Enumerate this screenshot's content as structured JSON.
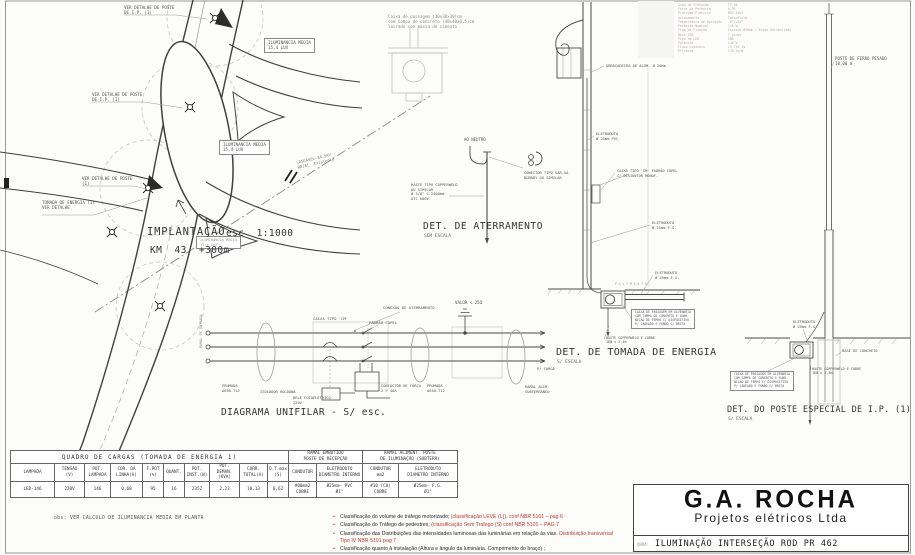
{
  "sheet": {
    "bg": "#fcfcfb",
    "line": "#3c3c3c",
    "grey": "#9a9a9a",
    "red": "#c0392b"
  },
  "plan": {
    "title": "IMPLANTAÇÃO",
    "scale": "esc  1:1000",
    "km": "KM  43  +300m"
  },
  "sections": {
    "aterramento": {
      "title": "DET. DE ATERRAMENTO",
      "subtitle": "SEM ESCALA"
    },
    "unifilar": {
      "title": "DIAGRAMA UNIFILAR - S/ esc."
    },
    "tomada": {
      "title": "DET. DE TOMADA DE ENERGIA",
      "subtitle": "S/ ESCALA"
    },
    "poste": {
      "title": "DET. DO POSTE ESPECIAL DE I.P. (1)",
      "subtitle": "S/ ESCALA"
    }
  },
  "luminaire": {
    "specs": [
      "Grau de Proteção          IP-66",
      "Fator de Potência         0,95",
      "Proteção Elétrica         MOV 10kV",
      "Acionamento               Fotocélula",
      "Temperatura de Operação   -5°/+45°",
      "Potência Nominal          146 W",
      "Tipo de Fixação           Encaixe Ø48mm / Braço Galvanizado",
      "Base LED                  7 pinos",
      "Tipo de LED               SMD",
      "Potência                  146 W",
      "Fluxo Luminoso            19.710 lm",
      "Eficácia                  135 lm/W"
    ]
  },
  "annotations": [
    {
      "n": "ver-detalhe-poste-1",
      "x": 124,
      "y": 5,
      "t": "VER DETALHE DE POSTE\nDE I.P. (1)"
    },
    {
      "n": "iluminancia-media-1",
      "x": 264,
      "y": 38,
      "t": "ILUMINANCIA MEDIA\n15,4 LUX",
      "box": true
    },
    {
      "n": "ver-detalhe-poste-2",
      "x": 92,
      "y": 92,
      "t": "VER DETALHE DE POSTE\nDE I.P. (1)"
    },
    {
      "n": "iluminancia-media-2",
      "x": 219,
      "y": 140,
      "t": "ILUMINANCIA MEDIA\n15,4 LUX",
      "box": true
    },
    {
      "n": "ver-detalhe-poste-3",
      "x": 82,
      "y": 176,
      "t": "VER DETALHE DE POSTE\n(1)"
    },
    {
      "n": "tomada-energia-ref",
      "x": 42,
      "y": 200,
      "t": "TOMADA DE ENERGIA (1)\nVER DETALHE"
    },
    {
      "n": "linha-345kv",
      "x": 296,
      "y": 160,
      "t": "CASCAVEL-34,5KV\nRD/At  Existente",
      "r": -13,
      "s": 3.9,
      "c": "#777"
    },
    {
      "n": "iluminancia-media-3",
      "x": 196,
      "y": 236,
      "t": "ILUMINANCIA MEDIA\n15,4 LUX",
      "box": true,
      "s": 3.6,
      "c": "#999"
    },
    {
      "n": "caixa-passagem-nota",
      "x": 388,
      "y": 14,
      "t": "Caixa de passagem (30x30x30)cm\ncom tampa de concreto (40x40x0,5)cm\nlacrado com massa de cimento",
      "s": 4.1,
      "c": "#8a8a8a"
    },
    {
      "n": "ao-neutro",
      "x": 464,
      "y": 137,
      "t": "AO NEUTRO",
      "s": 4
    },
    {
      "n": "conector-label",
      "x": 524,
      "y": 171,
      "t": "CONECTOR TIPO GAR-GA\nBURNDY OU SIMILAR",
      "s": 3.7
    },
    {
      "n": "haste-label",
      "x": 411,
      "y": 183,
      "t": "HASTE TIPO COPPERWELD\nOU SIMILAR\nØ 5/8\" C-2400mm\nATC 600V",
      "s": 3.7
    },
    {
      "n": "caixa-tipo-cm",
      "x": 313,
      "y": 316,
      "t": "CAIXA TIPO 'CM'",
      "s": 3.9
    },
    {
      "n": "conexao-aterramento",
      "x": 383,
      "y": 305,
      "t": "CONEXÃO DE ATERRAMENTO",
      "s": 3.9
    },
    {
      "n": "padrao-copel",
      "x": 369,
      "y": 320,
      "t": "PADRÃO COPEL",
      "s": 3.9
    },
    {
      "n": "valor-25-ohm",
      "x": 455,
      "y": 300,
      "t": "VALOR < 25Ω",
      "s": 4.1
    },
    {
      "n": "isolador-roldana",
      "x": 260,
      "y": 390,
      "t": "ISOLADOR ROLDANA",
      "s": 3.7
    },
    {
      "n": "rele-fotoeletrico",
      "x": 293,
      "y": 396,
      "t": "RELÉ FOTOELÉTRICO\n220V",
      "s": 3.7
    },
    {
      "n": "contactor-forca",
      "x": 381,
      "y": 384,
      "t": "CONTACTOR DE FORÇA\n2 P 40A",
      "s": 3.7
    },
    {
      "n": "prumada-esq",
      "x": 222,
      "y": 384,
      "t": "PRUMADA\nA650-T12",
      "s": 3.7
    },
    {
      "n": "prumada-dir",
      "x": 427,
      "y": 384,
      "t": "PRUMADA\nA650-T12",
      "s": 3.7
    },
    {
      "n": "ramal-subterraneo",
      "x": 525,
      "y": 385,
      "t": "RAMAL ALIM.\nSUBTERRÂNEO",
      "s": 3.7
    },
    {
      "n": "p-carga",
      "x": 537,
      "y": 367,
      "t": "P/ CARGA",
      "s": 3.7
    },
    {
      "n": "ramal-entrada",
      "x": 199,
      "y": 348,
      "t": "RAMAL DE ENTRADA",
      "s": 3.5,
      "r": -90,
      "c": "#888"
    },
    {
      "n": "abracadeira",
      "x": 606,
      "y": 64,
      "t": "ABRAÇADEIRA DE ALUM. Ø 20mm",
      "s": 3.7
    },
    {
      "n": "eletroduto-pvc",
      "x": 596,
      "y": 132,
      "t": "ELETRODUTO\nØ 25mm PVC",
      "s": 3.7
    },
    {
      "n": "caixa-cm-poste",
      "x": 617,
      "y": 169,
      "t": "CAIXA TIPO 'CM' PADRÃO COPEL\nC/ DISJUNTOR MONOF.",
      "s": 3.6
    },
    {
      "n": "eletroduto-fg-1",
      "x": 652,
      "y": 221,
      "t": "ELETRODUTO\nØ 25mm F.G.",
      "s": 3.7
    },
    {
      "n": "eletroduto-fg-2",
      "x": 655,
      "y": 271,
      "t": "ELETRODUTO\nØ 25mm F.G.",
      "s": 3.7
    },
    {
      "n": "pavimento",
      "x": 615,
      "y": 283,
      "t": "P A V I M E N T O",
      "s": 3.1,
      "c": "#999"
    },
    {
      "n": "caixa-alvenaria-1",
      "x": 631,
      "y": 309,
      "t": "CAIXA DE PASSAGEM EM ALVENARIA\nCOM TAMPA DE CONCRETO E GUAR-\nNIÇÃO DE FERRO C/ DISPOSITIVO\nP/ CADEADO E FUNDO C/ BRITA",
      "s": 3.1,
      "box": true
    },
    {
      "n": "haste-tomada",
      "x": 606,
      "y": 336,
      "t": "HASTE COPPERWELD E COBRE\n16Ø x 2,4m",
      "s": 3.4
    },
    {
      "n": "poste-ferro-pesado",
      "x": 835,
      "y": 56,
      "t": "POSTE DE FERRO PESADO\n10,00 m",
      "s": 4.1
    },
    {
      "n": "eletroduto-fg-3",
      "x": 793,
      "y": 320,
      "t": "ELETRODUTO\nØ 25mm F.G.",
      "s": 3.7
    },
    {
      "n": "base-concreto",
      "x": 842,
      "y": 349,
      "t": "BASE DE CONCRETO",
      "s": 3.7
    },
    {
      "n": "haste-poste",
      "x": 812,
      "y": 367,
      "t": "HASTE COPPERWELD E COBRE\n16Ø x 2,4m",
      "s": 3.4
    },
    {
      "n": "caixa-alvenaria-2",
      "x": 730,
      "y": 371,
      "t": "CAIXA DE PASSAGEM EM ALVENARIA\nCOM TAMPA DE CONCRETO E GUAR-\nNIÇÃO DE FERRO C/ DISPOSITIVO\nP/ CADEADO E FUNDO C/ BRITA",
      "s": 3.1,
      "box": true
    }
  ],
  "table": {
    "title": "QUADRO DE CARGAS      (TOMADA DE ENERGIA 1)",
    "group2": "RAMAL EMBUTIDO\nPOSTE DE RECEPÇÃO",
    "group3": "RAMAL ALIMENT. POSTE\nDE ILUMINAÇÃO (SUBTERR)",
    "columns": [
      "LAMPADA",
      "TENSÃO\n(V)",
      "POT.\nLAMPADA",
      "COR. DA\nLINHA(A)",
      "F.POT\n(%)",
      "QUANT.",
      "POT.\nINST.(W)",
      "POT.\nDEMAN.(KVA)",
      "CORR.\nTOTAL(A)",
      "Q.T.máx\n(S)",
      "CONDUTOR",
      "ELETRODUTO\nDIAMETRO INTERNO",
      "CONDUTOR\nmm2",
      "ELETRODUTO\nDIAMETRO INTERNO"
    ],
    "row": [
      "LED-146",
      "220V",
      "146",
      "0,68",
      "95",
      "16",
      "2352",
      "2,23",
      "10,13",
      "0,62",
      "#00mm2\nCOBRE",
      "Ø25mm- PVC\nØ1\"",
      "#10 (CU)\nCOBRE",
      "Ø25mm- F.G.\nØ1\""
    ],
    "obs": "obs: VER CALCULO DE ILUMINANCIA MEDIA EM PLANTA"
  },
  "notes": [
    [
      {
        "t": "Classificação do volume de tráfego motorizado;    ",
        "c": "k"
      },
      {
        "t": "(classificação LEVE (L)), conf NBR 5101 – pag 6",
        "c": "r"
      }
    ],
    [
      {
        "t": "Classificação do Tráfego de pedestres;        ",
        "c": "k"
      },
      {
        "t": "(classificação  Sem Trafego (S) conf NBR 5101 – PAG 7",
        "c": "r"
      }
    ],
    [
      {
        "t": "Classificação das Distribuições das intensidades luminosas das luminárias em relação às vias. ",
        "c": "k"
      },
      {
        "t": "Distribuição transversal  Tipo IV NBR 5101 pag 7",
        "c": "r"
      }
    ],
    [
      {
        "t": "Classificação quanto à instalação (Altura e ângulo da luminária. Comprimento do braço) ;",
        "c": "k"
      }
    ]
  ],
  "titleblock": {
    "logo": "G.A. ROCHA",
    "logo_sub": "Projetos elétricos Ltda",
    "obra_label": "OBRA:",
    "obra": "ILUMINAÇÃO INTERSEÇÃO ROD PR 462"
  }
}
